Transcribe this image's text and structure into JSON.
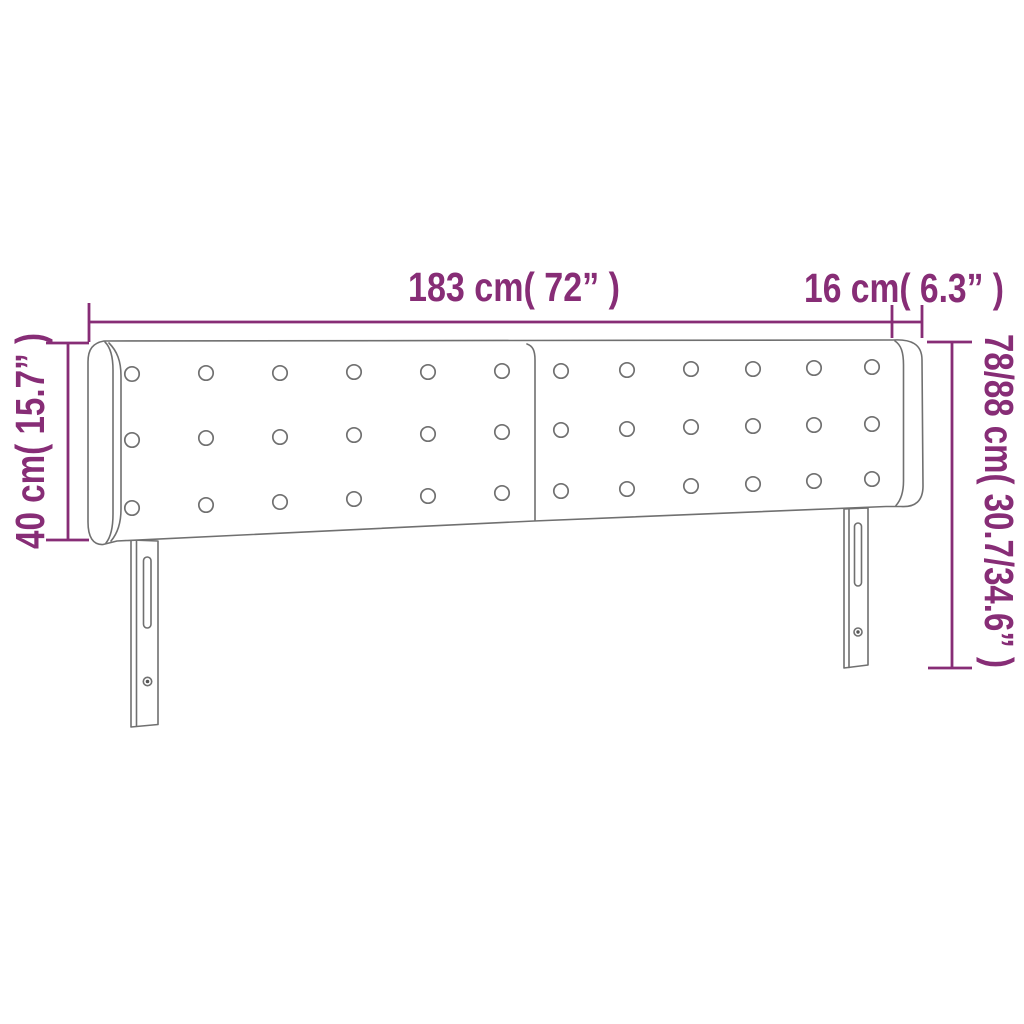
{
  "page": {
    "background_color": "#ffffff"
  },
  "diagram": {
    "kind": "furniture-dimension-diagram",
    "subject": "tufted headboard with side wings and two slotted legs",
    "accent_color": "#872d76",
    "outline_color": "#707070",
    "labels": {
      "width": "183 cm( 72” )",
      "wing_depth": "16 cm( 6.3” )",
      "headboard_height": "40 cm( 15.7” )",
      "total_height": "78/88 cm( 30.7/34.6” )"
    }
  }
}
